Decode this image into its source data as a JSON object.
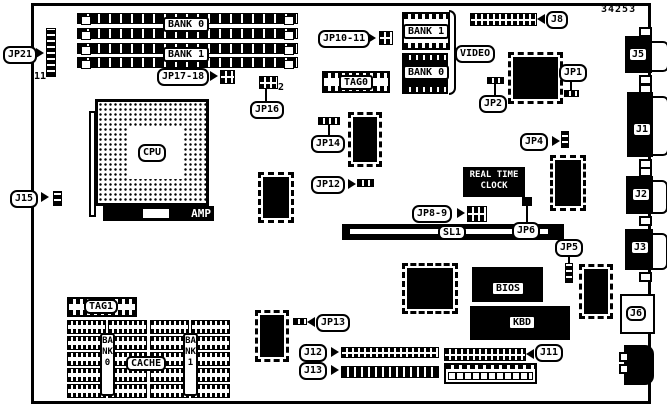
{
  "part_number": "34253",
  "memory": {
    "bank0": "BANK 0",
    "bank1": "BANK 1"
  },
  "cpu": {
    "label": "CPU",
    "brand": "AMP"
  },
  "video": {
    "group_label": "VIDEO",
    "bank1": "BANK 1",
    "bank0": "BANK 0",
    "tag0": "TAG0"
  },
  "rtc": {
    "line1": "REAL TIME",
    "line2": "CLOCK"
  },
  "rom": {
    "bios": "BIOS",
    "kbd": "KBD"
  },
  "cache": {
    "tag1": "TAG1",
    "label": "CACHE",
    "bank0": "BANK0",
    "bank1": "BANK1"
  },
  "slots": {
    "sl1": "SL1"
  },
  "jumpers": {
    "jp21": {
      "label": "JP21",
      "pin": "11"
    },
    "j15": "J15",
    "jp17_18": "JP17-18",
    "jp16": {
      "label": "JP16",
      "pin": "2"
    },
    "jp10_11": "JP10-11",
    "jp1": "JP1",
    "jp2": "JP2",
    "jp14": "JP14",
    "jp12": "JP12",
    "jp4": "JP4",
    "jp8_9": "JP8-9",
    "jp6": "JP6",
    "jp5": "JP5",
    "jp13": "JP13"
  },
  "connectors": {
    "j8": "J8",
    "j5": "J5",
    "j1": "J1",
    "j2": "J2",
    "j3": "J3",
    "j6": "J6",
    "j12": "J12",
    "j13": "J13",
    "j11": "J11"
  },
  "colors": {
    "ink": "#000000",
    "paper": "#ffffff"
  }
}
